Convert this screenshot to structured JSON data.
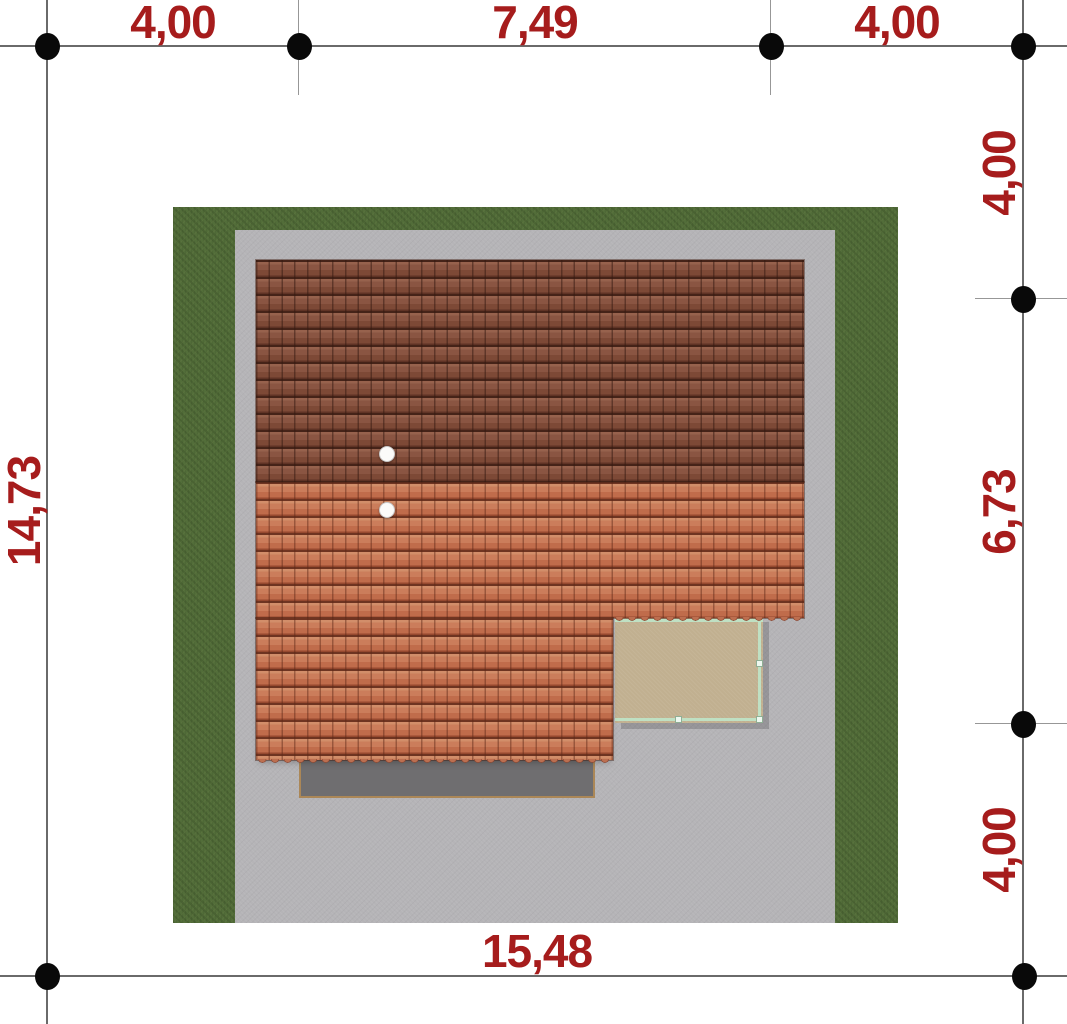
{
  "plan": {
    "description": "Top-down architectural site plan: house roof on a grass plot with paved yard, terrace and dimension lines",
    "dimension_labels": {
      "top": [
        "4,00",
        "7,49",
        "4,00"
      ],
      "right": [
        "4,00",
        "6,73",
        "4,00"
      ],
      "left": [
        "14,73"
      ],
      "bottom": [
        "15,48"
      ]
    },
    "colors": {
      "dimension_text": "#a61c1c",
      "grass": "#526d39",
      "paving": "#b5b4b7",
      "roof_north_slope": "#875140",
      "roof_south_slope": "#c5714f",
      "terrace": "#c1b090",
      "railing": "#bfe0c3",
      "pad": "#6f6e70"
    },
    "chimney_count": "2"
  }
}
